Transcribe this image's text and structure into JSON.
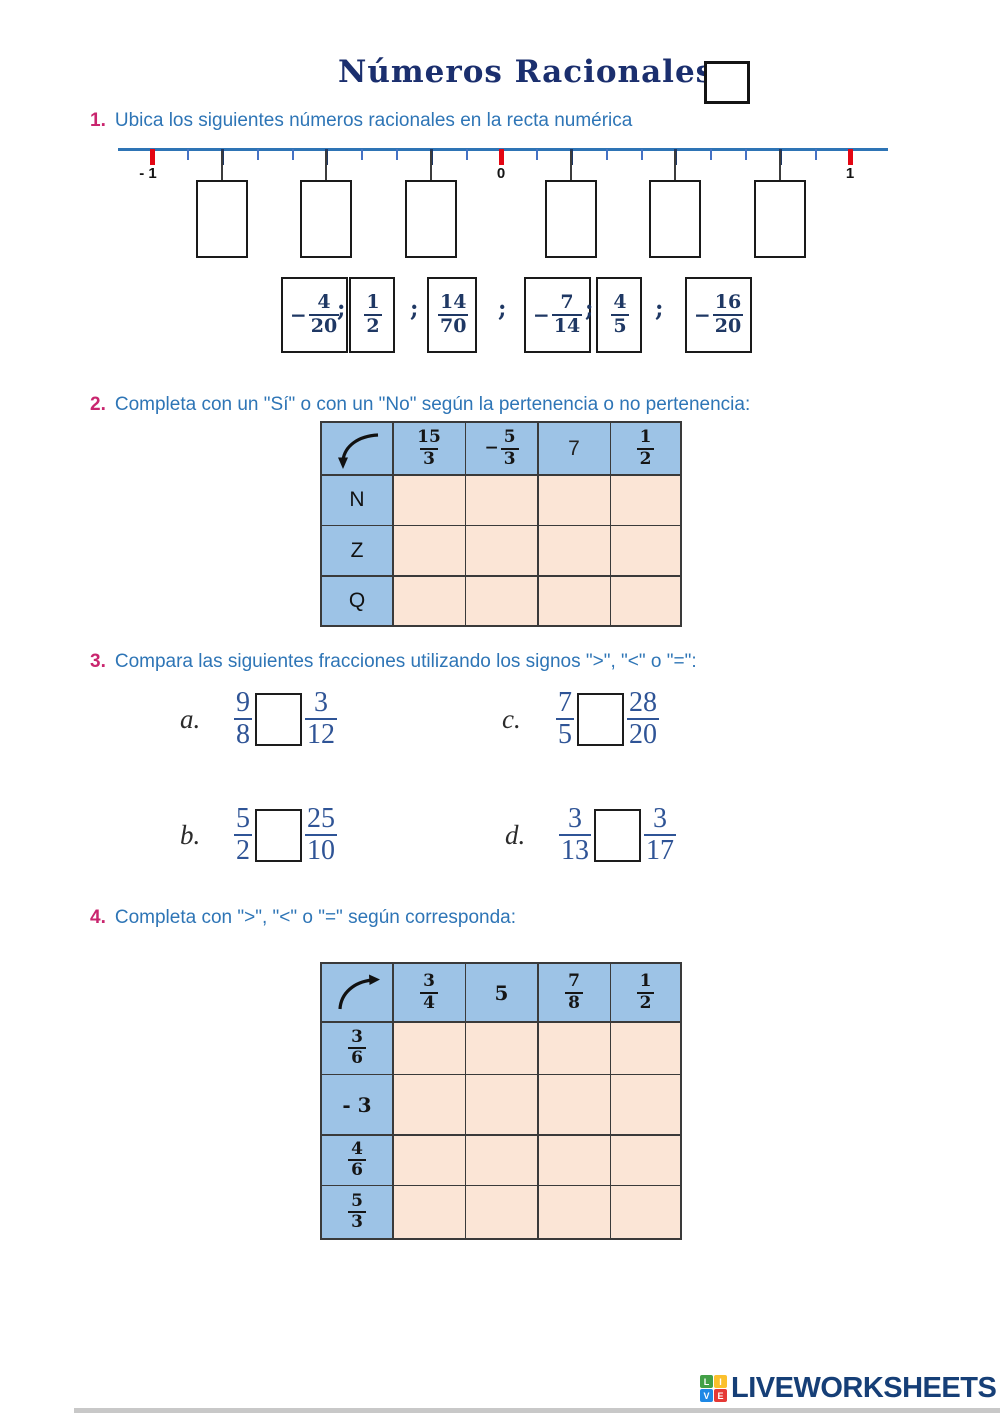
{
  "title": {
    "text": "Números Racionales"
  },
  "colors": {
    "title_navy": "#1b2f6e",
    "prompt_blue": "#2e75b6",
    "item_number_magenta": "#c9256e",
    "fraction_navy": "#1f3864",
    "comparison_blue": "#2f5496",
    "table_header_blue": "#9dc3e6",
    "table_cell_peach": "#fbe5d6",
    "tick_red": "#e30613",
    "line_blue": "#2e74b5"
  },
  "ex1": {
    "number": "1.",
    "prompt": "Ubica los siguientes números racionales en la recta numérica",
    "line_labels": {
      "minus_one": "- 1",
      "zero": "0",
      "one": "1"
    },
    "separator": ";",
    "fractions": [
      {
        "sign": "−",
        "num": "4",
        "den": "20"
      },
      {
        "sign": "",
        "num": "1",
        "den": "2"
      },
      {
        "sign": "",
        "num": "14",
        "den": "70"
      },
      {
        "sign": "−",
        "num": "7",
        "den": "14"
      },
      {
        "sign": "",
        "num": "4",
        "den": "5"
      },
      {
        "sign": "−",
        "num": "16",
        "den": "20"
      }
    ]
  },
  "ex2": {
    "number": "2.",
    "prompt": "Completa con un \"Sí\" o con un \"No\" según la pertenencia o no pertenencia:",
    "headers": {
      "h1": {
        "num": "15",
        "den": "3"
      },
      "h2": {
        "sign": "−",
        "num": "5",
        "den": "3"
      },
      "h3": "7",
      "h4": {
        "num": "1",
        "den": "2"
      }
    },
    "row_labels": [
      "N",
      "Z",
      "Q"
    ]
  },
  "ex3": {
    "number": "3.",
    "prompt": "Compara las siguientes fracciones utilizando los signos \">\", \"<\" o \"=\":",
    "items": [
      {
        "label": "a.",
        "l_num": "9",
        "l_den": "8",
        "r_num": "3",
        "r_den": "12"
      },
      {
        "label": "c.",
        "l_num": "7",
        "l_den": "5",
        "r_num": "28",
        "r_den": "20"
      },
      {
        "label": "b.",
        "l_num": "5",
        "l_den": "2",
        "r_num": "25",
        "r_den": "10"
      },
      {
        "label": "d.",
        "l_num": "3",
        "l_den": "13",
        "r_num": "3",
        "r_den": "17"
      }
    ]
  },
  "ex4": {
    "number": "4.",
    "prompt": "Completa con \">\", \"<\" o \"=\" según corresponda:",
    "headers": {
      "h1": {
        "num": "3",
        "den": "4"
      },
      "h2": "5",
      "h3": {
        "num": "7",
        "den": "8"
      },
      "h4": {
        "num": "1",
        "den": "2"
      }
    },
    "row_headers": {
      "r1": {
        "num": "3",
        "den": "6"
      },
      "r2": "- 3",
      "r3": {
        "num": "4",
        "den": "6"
      },
      "r4": {
        "num": "5",
        "den": "3"
      }
    }
  },
  "footer": {
    "brand": "LIVEWORKSHEETS",
    "logo_letters": [
      "L",
      "I",
      "V",
      "E"
    ],
    "logo_colors": [
      "#43a047",
      "#fbc02d",
      "#1e88e5",
      "#e53935"
    ]
  }
}
